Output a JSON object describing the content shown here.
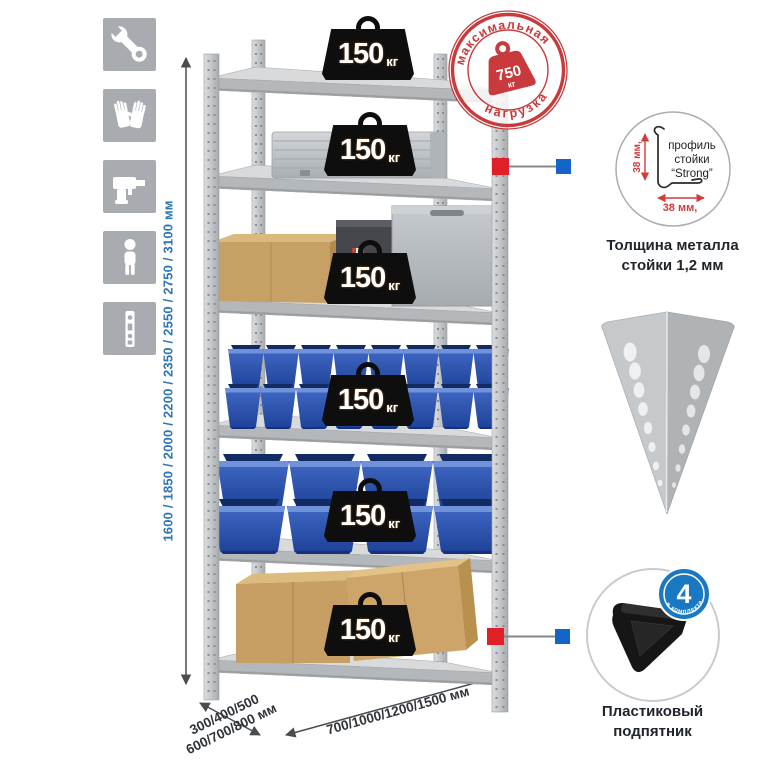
{
  "tool_icons": {
    "items": [
      {
        "name": "wrench-icon"
      },
      {
        "name": "gloves-icon"
      },
      {
        "name": "drill-icon"
      },
      {
        "name": "person-icon"
      },
      {
        "name": "upright-profile-icon"
      }
    ]
  },
  "height_dimension": {
    "label": "1600 / 1850 / 2000 / 2200 / 2350 / 2550 / 2750 / 3100 мм"
  },
  "max_load_stamp": {
    "arc_top": "максимальная",
    "arc_bottom": "нагрузка",
    "value": "750",
    "unit": "кг"
  },
  "shelf_load_badges": {
    "unit": "кг",
    "values": [
      "150",
      "150",
      "150",
      "150",
      "150",
      "150"
    ]
  },
  "post_profile_detail": {
    "label_line1": "профиль",
    "label_line2": "стойки",
    "label_line3": "“Strong”",
    "dim_vertical": "38 мм,",
    "dim_horizontal": "38 мм,",
    "caption_line1": "Толщина металла",
    "caption_line2": "стойки 1,2 мм"
  },
  "corner_foot_detail": {
    "badge_value": "4",
    "badge_arc": "в комплекте",
    "caption_line1": "Пластиковый",
    "caption_line2": "подпятник"
  },
  "base_dimensions": {
    "depth_line1": "300/400/500",
    "depth_line2": "600/700/800 мм",
    "width_label": "700/1000/1200/1500 мм"
  },
  "colors": {
    "accent_blue": "#2e75b6",
    "stamp_red": "#c93a3c",
    "marker_red": "#e01f26",
    "marker_blue": "#1465c8",
    "bin_blue": "#2f5cb0",
    "icon_gray": "#a8acb1"
  }
}
